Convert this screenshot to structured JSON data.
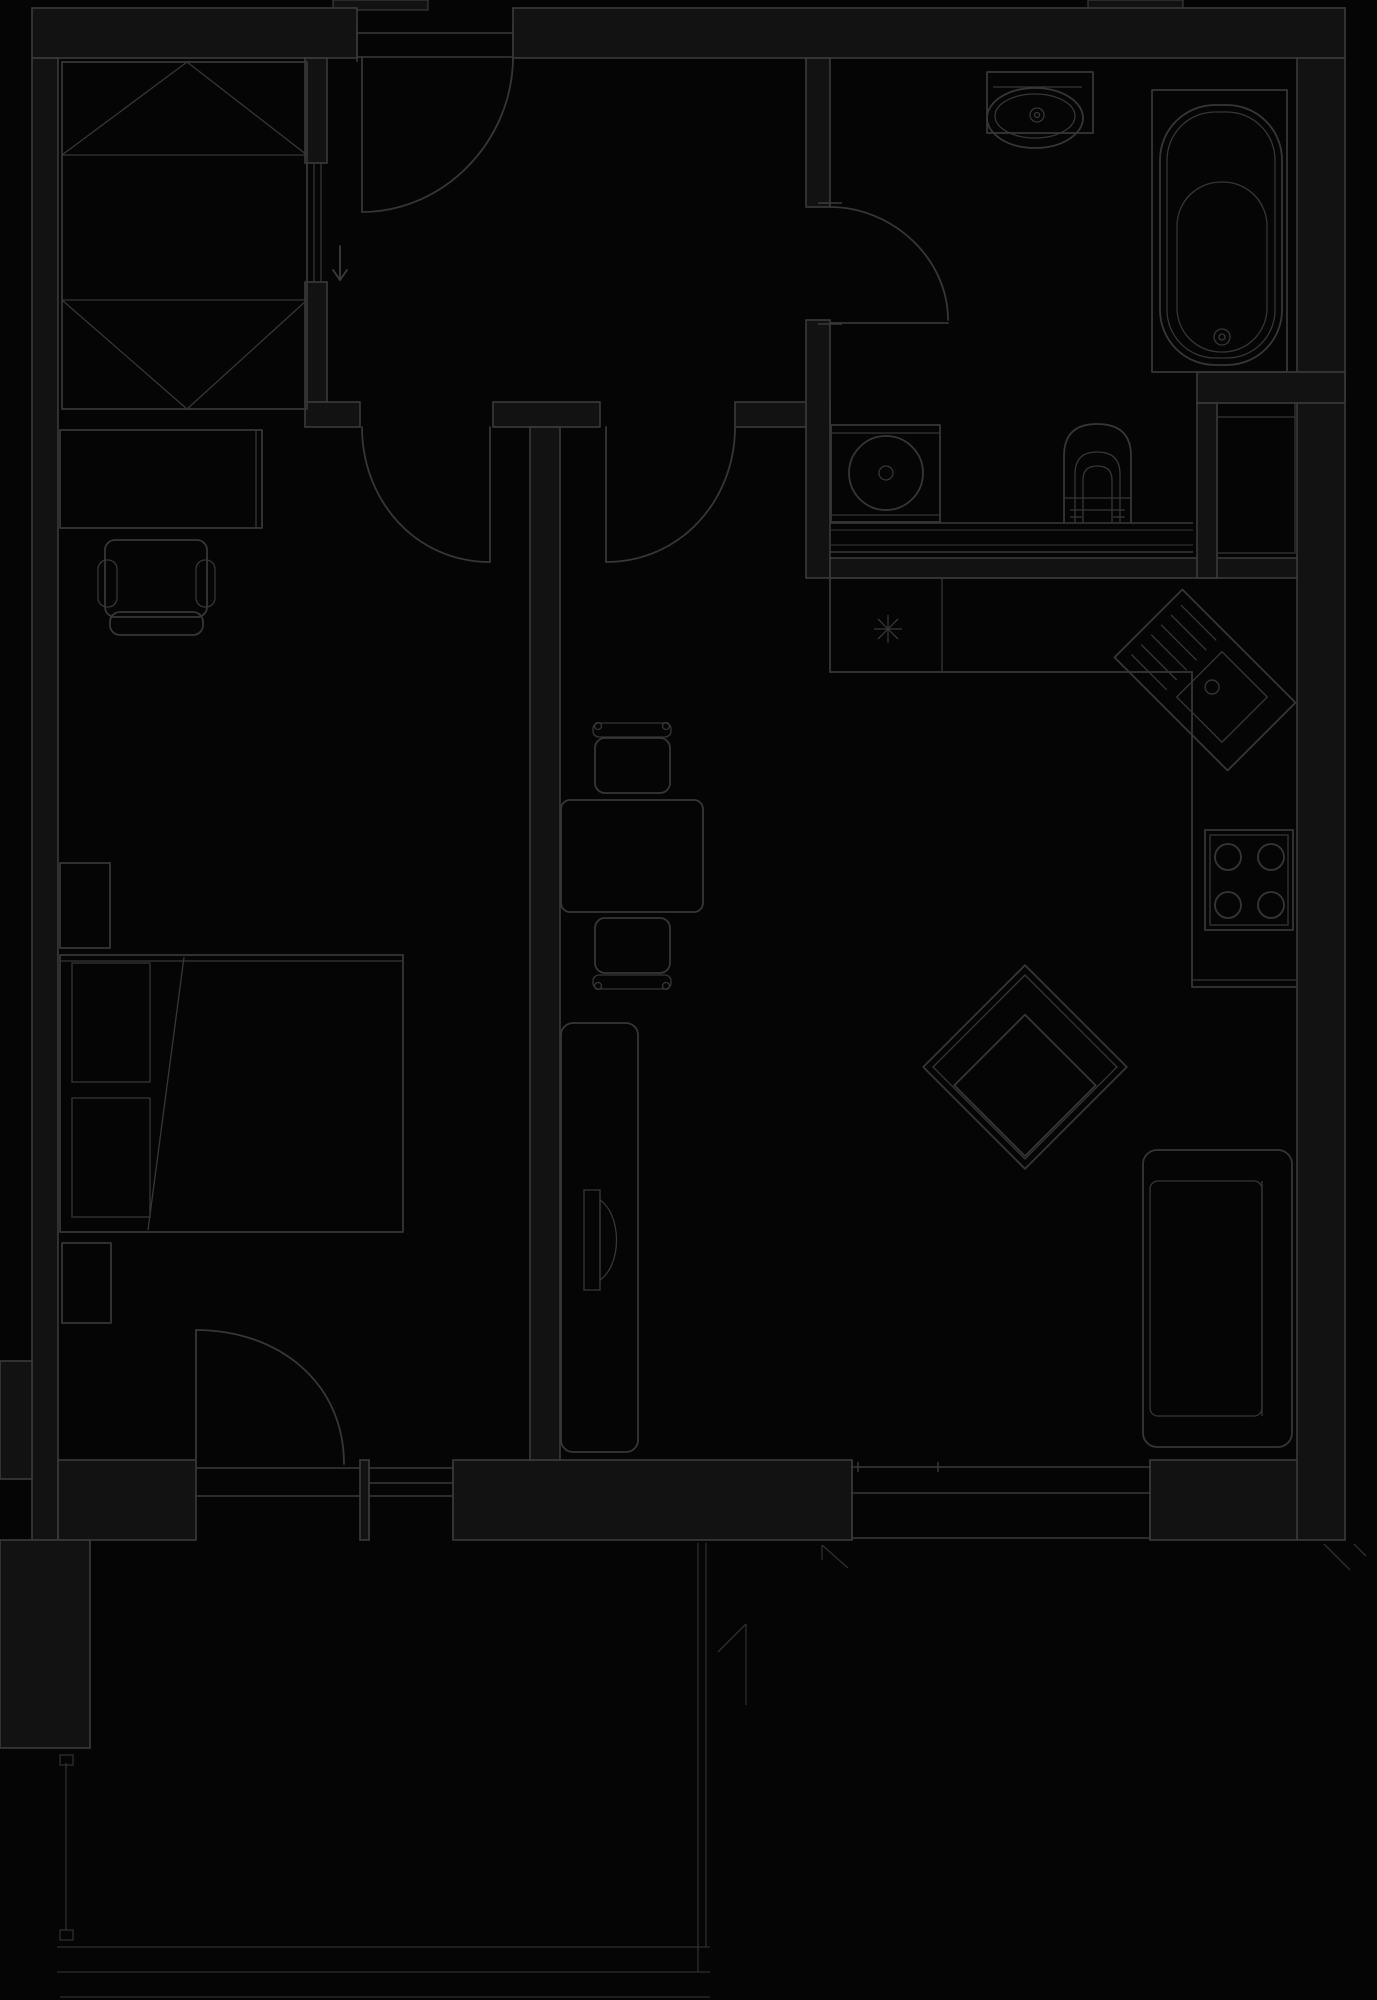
{
  "meta": {
    "type": "architectural-floor-plan",
    "description": "Dark one-bedroom apartment floor plan with hall, storage nook, bathroom, kitchen, living-dining room, bedroom and balcony",
    "theme": "blueprint-dark"
  },
  "colors": {
    "background": "#050505",
    "wall_fill": "#121212",
    "wall_line": "#3a3a3a",
    "furniture_line": "#363636",
    "soft_line": "#2e2e2e"
  },
  "rooms": [
    {
      "id": "storage-nook",
      "label": "Storage / wardrobe nook"
    },
    {
      "id": "hall",
      "label": "Entry hall"
    },
    {
      "id": "bathroom",
      "label": "Bathroom"
    },
    {
      "id": "bedroom",
      "label": "Bedroom"
    },
    {
      "id": "kitchen",
      "label": "Kitchen"
    },
    {
      "id": "living-dining",
      "label": "Living / dining room"
    },
    {
      "id": "balcony",
      "label": "Balcony"
    }
  ],
  "fixtures": [
    {
      "id": "wardrobe",
      "room": "storage-nook",
      "label": "Built-in wardrobe with fold-out doors"
    },
    {
      "id": "sliding-door",
      "room": "hall",
      "label": "Sliding door to storage nook"
    },
    {
      "id": "entry-door",
      "room": "hall",
      "label": "Apartment entry door"
    },
    {
      "id": "entry-arrow",
      "room": "hall",
      "label": "Entry direction arrow"
    },
    {
      "id": "bedroom-door",
      "room": "hall",
      "label": "Door to bedroom"
    },
    {
      "id": "living-door",
      "room": "hall",
      "label": "Door to living room"
    },
    {
      "id": "bathroom-door",
      "room": "bathroom",
      "label": "Bathroom door"
    },
    {
      "id": "washbasin",
      "room": "bathroom",
      "label": "Washbasin"
    },
    {
      "id": "bathtub",
      "room": "bathroom",
      "label": "Bathtub"
    },
    {
      "id": "washing-machine",
      "room": "bathroom",
      "label": "Washing machine"
    },
    {
      "id": "toilet",
      "room": "bathroom",
      "label": "Toilet"
    },
    {
      "id": "utility-shaft",
      "room": "kitchen",
      "label": "Utility shaft / tall cabinet"
    },
    {
      "id": "dishwasher",
      "room": "kitchen",
      "label": "Dishwasher with star mark"
    },
    {
      "id": "kitchen-counter",
      "room": "kitchen",
      "label": "L-shaped kitchen counter"
    },
    {
      "id": "corner-sink",
      "room": "kitchen",
      "label": "Diagonal corner sink with drainboard"
    },
    {
      "id": "stove",
      "room": "kitchen",
      "label": "Four-burner stove"
    },
    {
      "id": "desk",
      "room": "bedroom",
      "label": "Desk"
    },
    {
      "id": "desk-chair",
      "room": "bedroom",
      "label": "Desk chair"
    },
    {
      "id": "nightstand-upper",
      "room": "bedroom",
      "label": "Nightstand (head side)"
    },
    {
      "id": "double-bed",
      "room": "bedroom",
      "label": "Double bed with pillows and throw line"
    },
    {
      "id": "nightstand-lower",
      "room": "bedroom",
      "label": "Nightstand (foot side)"
    },
    {
      "id": "balcony-door",
      "room": "bedroom",
      "label": "Balcony door"
    },
    {
      "id": "bedroom-window",
      "room": "bedroom",
      "label": "Window beside balcony door"
    },
    {
      "id": "dining-chair-top",
      "room": "living-dining",
      "label": "Dining chair (upper)"
    },
    {
      "id": "dining-table",
      "room": "living-dining",
      "label": "Dining table"
    },
    {
      "id": "dining-chair-bottom",
      "room": "living-dining",
      "label": "Dining chair (lower)"
    },
    {
      "id": "tv-sideboard",
      "room": "living-dining",
      "label": "TV sideboard"
    },
    {
      "id": "tv",
      "room": "living-dining",
      "label": "Television"
    },
    {
      "id": "armchair",
      "room": "living-dining",
      "label": "Armchair turned 45 degrees"
    },
    {
      "id": "sofa",
      "room": "living-dining",
      "label": "Sofa along right wall"
    },
    {
      "id": "living-window",
      "room": "living-dining",
      "label": "Living room window"
    },
    {
      "id": "balcony-railing",
      "room": "balcony",
      "label": "Balcony railing"
    }
  ]
}
